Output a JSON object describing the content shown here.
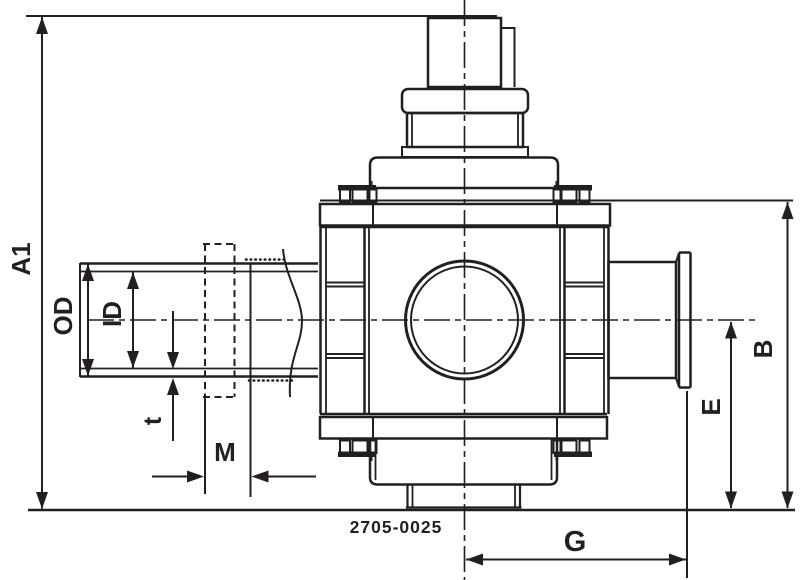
{
  "colors": {
    "line": "#231f20",
    "background": "#ffffff"
  },
  "drawing": {
    "part_number": "2705-0025",
    "labels": {
      "a1": "A1",
      "od": "OD",
      "id": "ID",
      "t": "t",
      "m": "M",
      "b": "B",
      "e": "E",
      "g": "G"
    }
  }
}
